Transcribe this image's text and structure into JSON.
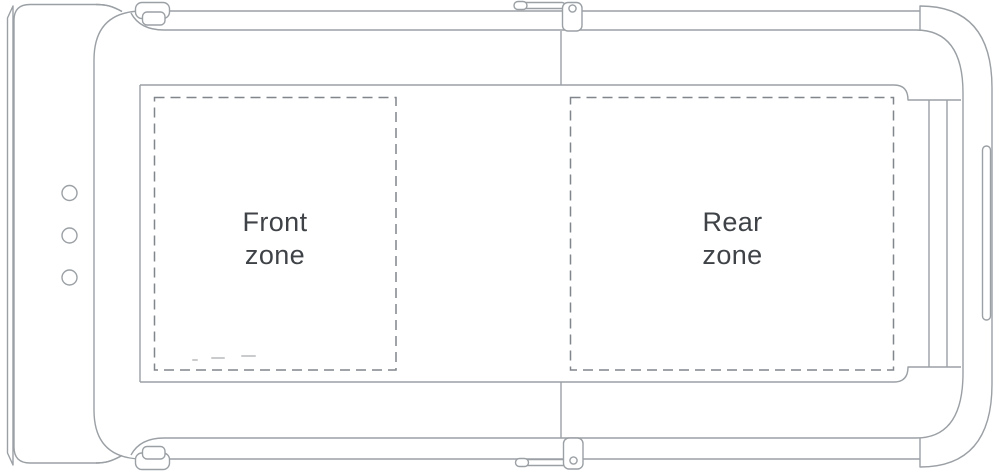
{
  "labels": {
    "front_zone": {
      "line1": "Front",
      "line2": "zone"
    },
    "rear_zone": {
      "line1": "Rear",
      "line2": "zone"
    }
  },
  "icons": {
    "console_indicator_dots": "three-round-indicator-dots",
    "top_latch": "latch-clip",
    "bottom_latch": "latch-clip",
    "top_hinge": "hinge-pivot-with-lever",
    "bottom_hinge": "hinge-pivot-with-lever",
    "side_slot": "vertical-slot"
  },
  "colors": {
    "background": "#ffffff",
    "outline": "#9ba0a5",
    "dashed_zone_border": "#80868b",
    "label_text": "#3f4347"
  }
}
